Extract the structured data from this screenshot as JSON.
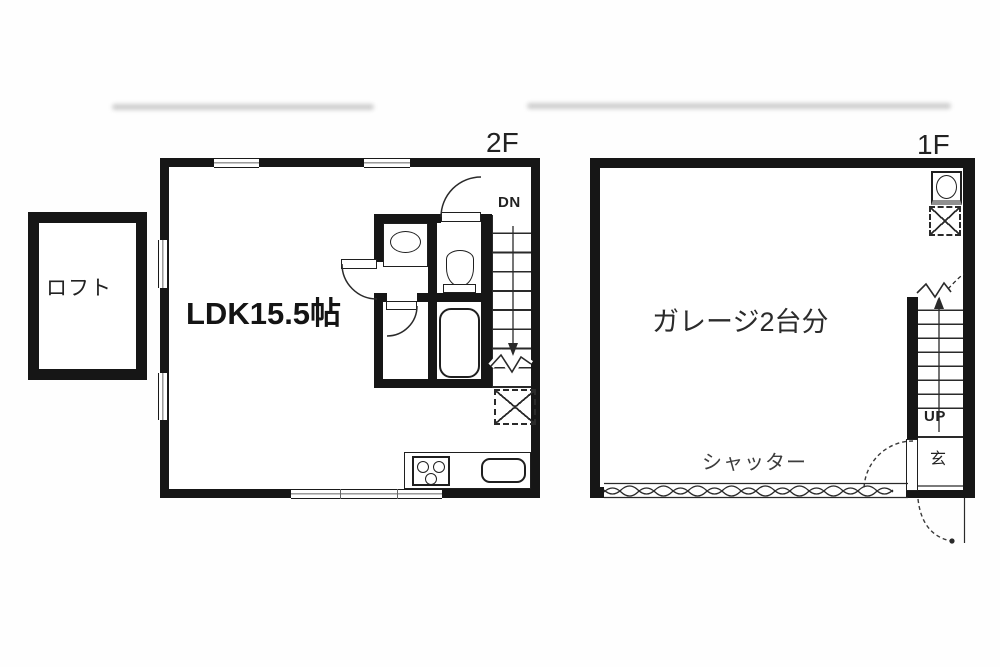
{
  "floors": {
    "second": {
      "label": "2F",
      "loft": "ロフト",
      "room": "LDK15.5帖",
      "stair": "DN"
    },
    "first": {
      "label": "1F",
      "room": "ガレージ2台分",
      "shutter": "シャッター",
      "stair": "UP",
      "entry": "玄"
    }
  },
  "colors": {
    "wall": "#161616",
    "line": "#2a2a2a",
    "background": "#fefefe"
  }
}
